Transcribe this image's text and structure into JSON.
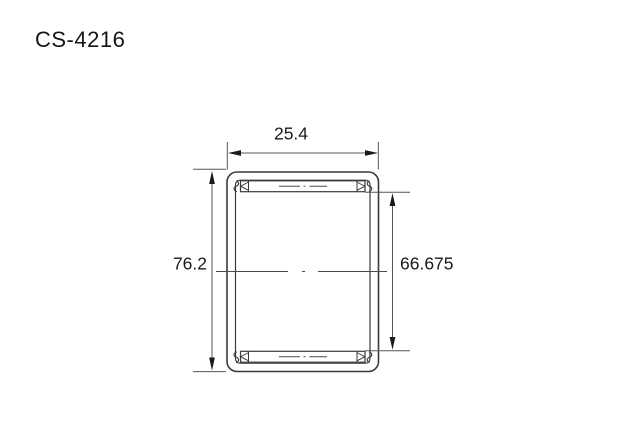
{
  "title": "CS-4216",
  "drawing": {
    "description_visible_text_only": "",
    "dimensions": {
      "width": {
        "label": "25.4",
        "value": 25.4
      },
      "outer_diameter": {
        "label": "76.2",
        "value": 76.2
      },
      "inner_diameter": {
        "label": "66.675",
        "value": 66.675
      }
    },
    "colors": {
      "background": "#ffffff",
      "outline": "#3a3a3a",
      "dimension_lines": "#555555",
      "wall_fill": "#d8d8d8",
      "text": "#1a1a1a"
    }
  }
}
